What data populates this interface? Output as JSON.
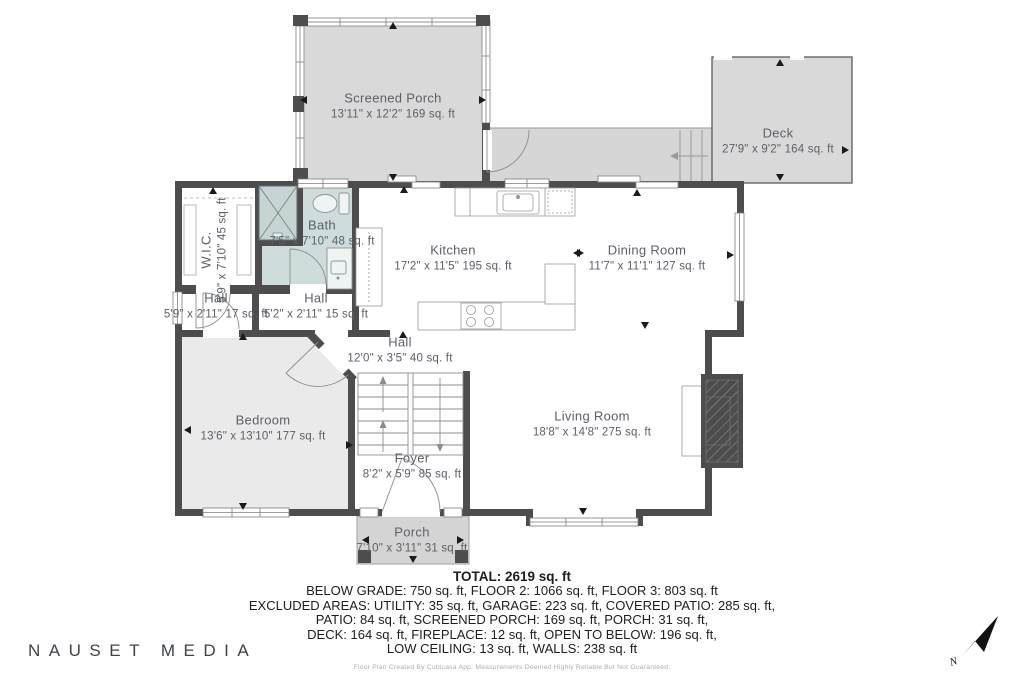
{
  "rooms": {
    "screened_porch": {
      "name": "Screened Porch",
      "dims": "13'11\" x 12'2\" 169 sq. ft"
    },
    "deck": {
      "name": "Deck",
      "dims": "27'9\" x 9'2\" 164 sq. ft"
    },
    "wic": {
      "name": "W.I.C.",
      "dims": "5'9\" x 7'10\" 45 sq. ft"
    },
    "bath": {
      "name": "Bath",
      "dims": "7'5\" x 7'10\" 48 sq. ft"
    },
    "hall_left": {
      "name": "Hall",
      "dims": "5'9\" x 2'11\" 17 sq. ft"
    },
    "hall_right": {
      "name": "Hall",
      "dims": "5'2\" x 2'11\" 15 sq. ft"
    },
    "kitchen": {
      "name": "Kitchen",
      "dims": "17'2\" x 11'5\" 195 sq. ft"
    },
    "dining": {
      "name": "Dining Room",
      "dims": "11'7\" x 11'1\" 127 sq. ft"
    },
    "hall_center": {
      "name": "Hall",
      "dims": "12'0\" x 3'5\" 40 sq. ft"
    },
    "bedroom": {
      "name": "Bedroom",
      "dims": "13'6\" x 13'10\" 177 sq. ft"
    },
    "living": {
      "name": "Living Room",
      "dims": "18'8\" x 14'8\" 275 sq. ft"
    },
    "foyer": {
      "name": "Foyer",
      "dims": "8'2\" x 5'9\" 85 sq. ft"
    },
    "porch": {
      "name": "Porch",
      "dims": "7'10\" x 3'11\" 31 sq. ft"
    }
  },
  "summary": {
    "total": "TOTAL: 2619 sq. ft",
    "line1": "BELOW GRADE: 750 sq. ft, FLOOR 2: 1066 sq. ft, FLOOR 3: 803 sq. ft",
    "line2": "EXCLUDED AREAS: UTILITY: 35 sq. ft, GARAGE: 223 sq. ft, COVERED PATIO: 285 sq. ft,",
    "line3": "PATIO: 84 sq. ft, SCREENED PORCH: 169 sq. ft, PORCH: 31 sq. ft,",
    "line4": "DECK: 164 sq. ft, FIREPLACE: 12 sq. ft, OPEN TO BELOW: 196 sq. ft,",
    "line5": "LOW CEILING: 13 sq. ft, WALLS: 238 sq. ft",
    "disclaimer": "Floor Plan Created By Cubicasa App. Measurements Deemed Highly Reliable But Not Guaranteed."
  },
  "branding": {
    "watermark": "NAUSET MEDIA"
  },
  "compass": {
    "label": "N"
  },
  "colors": {
    "wall": "#4d4d4d",
    "outdoor_fill": "#d9d9d9",
    "bedroom_fill": "#eaeaea",
    "bath_fill": "#cfdcdc",
    "label_text": "#5b6069",
    "summary_text": "#1e1e1e"
  }
}
